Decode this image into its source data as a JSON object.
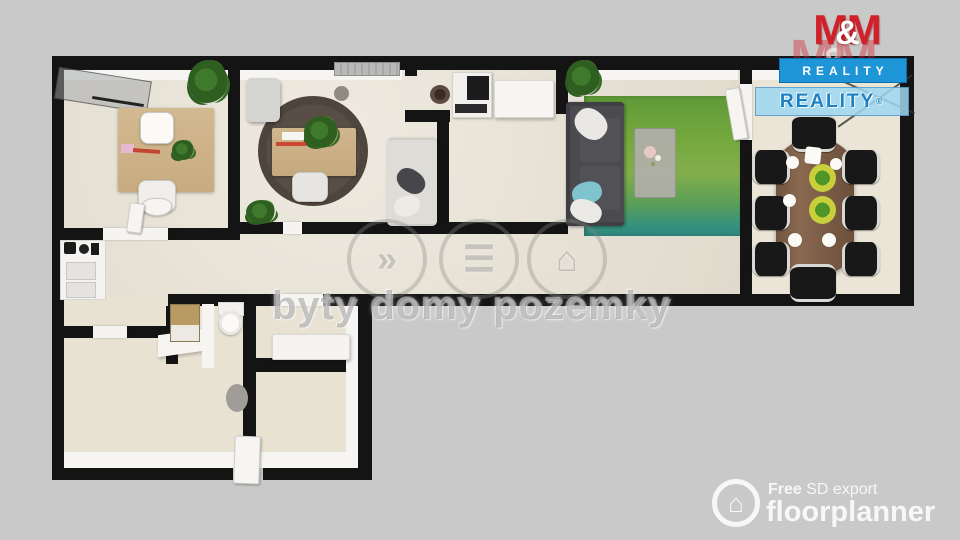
{
  "watermark_center": {
    "text": "byty domy pozemky",
    "icon_glyphs": [
      "»",
      "☰",
      "⌂"
    ],
    "icon_names": [
      "sound-waves-icon",
      "house-list-icon",
      "home-marker-icon"
    ]
  },
  "mm_reality_logo": {
    "m1": "M",
    "amp": "&",
    "m2": "M",
    "banner": "REALITY",
    "colors": {
      "red": "#d2202a",
      "banner_bg": "#1e95d6",
      "banner_text": "#ffffff"
    }
  },
  "mm_reality_watermark": {
    "m1": "M",
    "amp": "&",
    "m2": "M",
    "banner": "REALITY",
    "reg": "®",
    "colors": {
      "banner_bg": "#9ed7f0",
      "banner_text": "#1b7fc4"
    }
  },
  "floorplanner_badge": {
    "free": "Free",
    "export": " SD export",
    "brand": "floorplanner",
    "icon": "floorplanner-house-icon"
  },
  "floorplan": {
    "background": "#c9c9c9",
    "wall_color": "#141414",
    "floor_color": "#e9e3d5",
    "green_rug": "#6da33e",
    "rooms": [
      {
        "id": "office-1",
        "furniture": [
          "glass-whiteboard",
          "wood-desk",
          "white-chairs",
          "plants"
        ]
      },
      {
        "id": "office-2",
        "furniture": [
          "round-dark-rug",
          "wood-desk",
          "office-chair",
          "gray-cabinet",
          "radiator",
          "plants",
          "white-sofa-nook"
        ]
      },
      {
        "id": "corridor-kitchenette",
        "furniture": [
          "coffee-machine",
          "white-copier-box",
          "sideboard-with-appliances"
        ]
      },
      {
        "id": "lounge",
        "furniture": [
          "dark-gray-sofa",
          "green-rug",
          "coffee-table-with-flowers",
          "plant"
        ]
      },
      {
        "id": "meeting-room",
        "furniture": [
          "oval-wood-table",
          "eight-black-chairs",
          "plates",
          "salad-bowls",
          "floor-lamp"
        ]
      },
      {
        "id": "entry-bath-wing",
        "furniture": [
          "toilet",
          "tall-tan-cabinet",
          "bath-counter",
          "floor-mat",
          "entry-door"
        ]
      }
    ]
  }
}
